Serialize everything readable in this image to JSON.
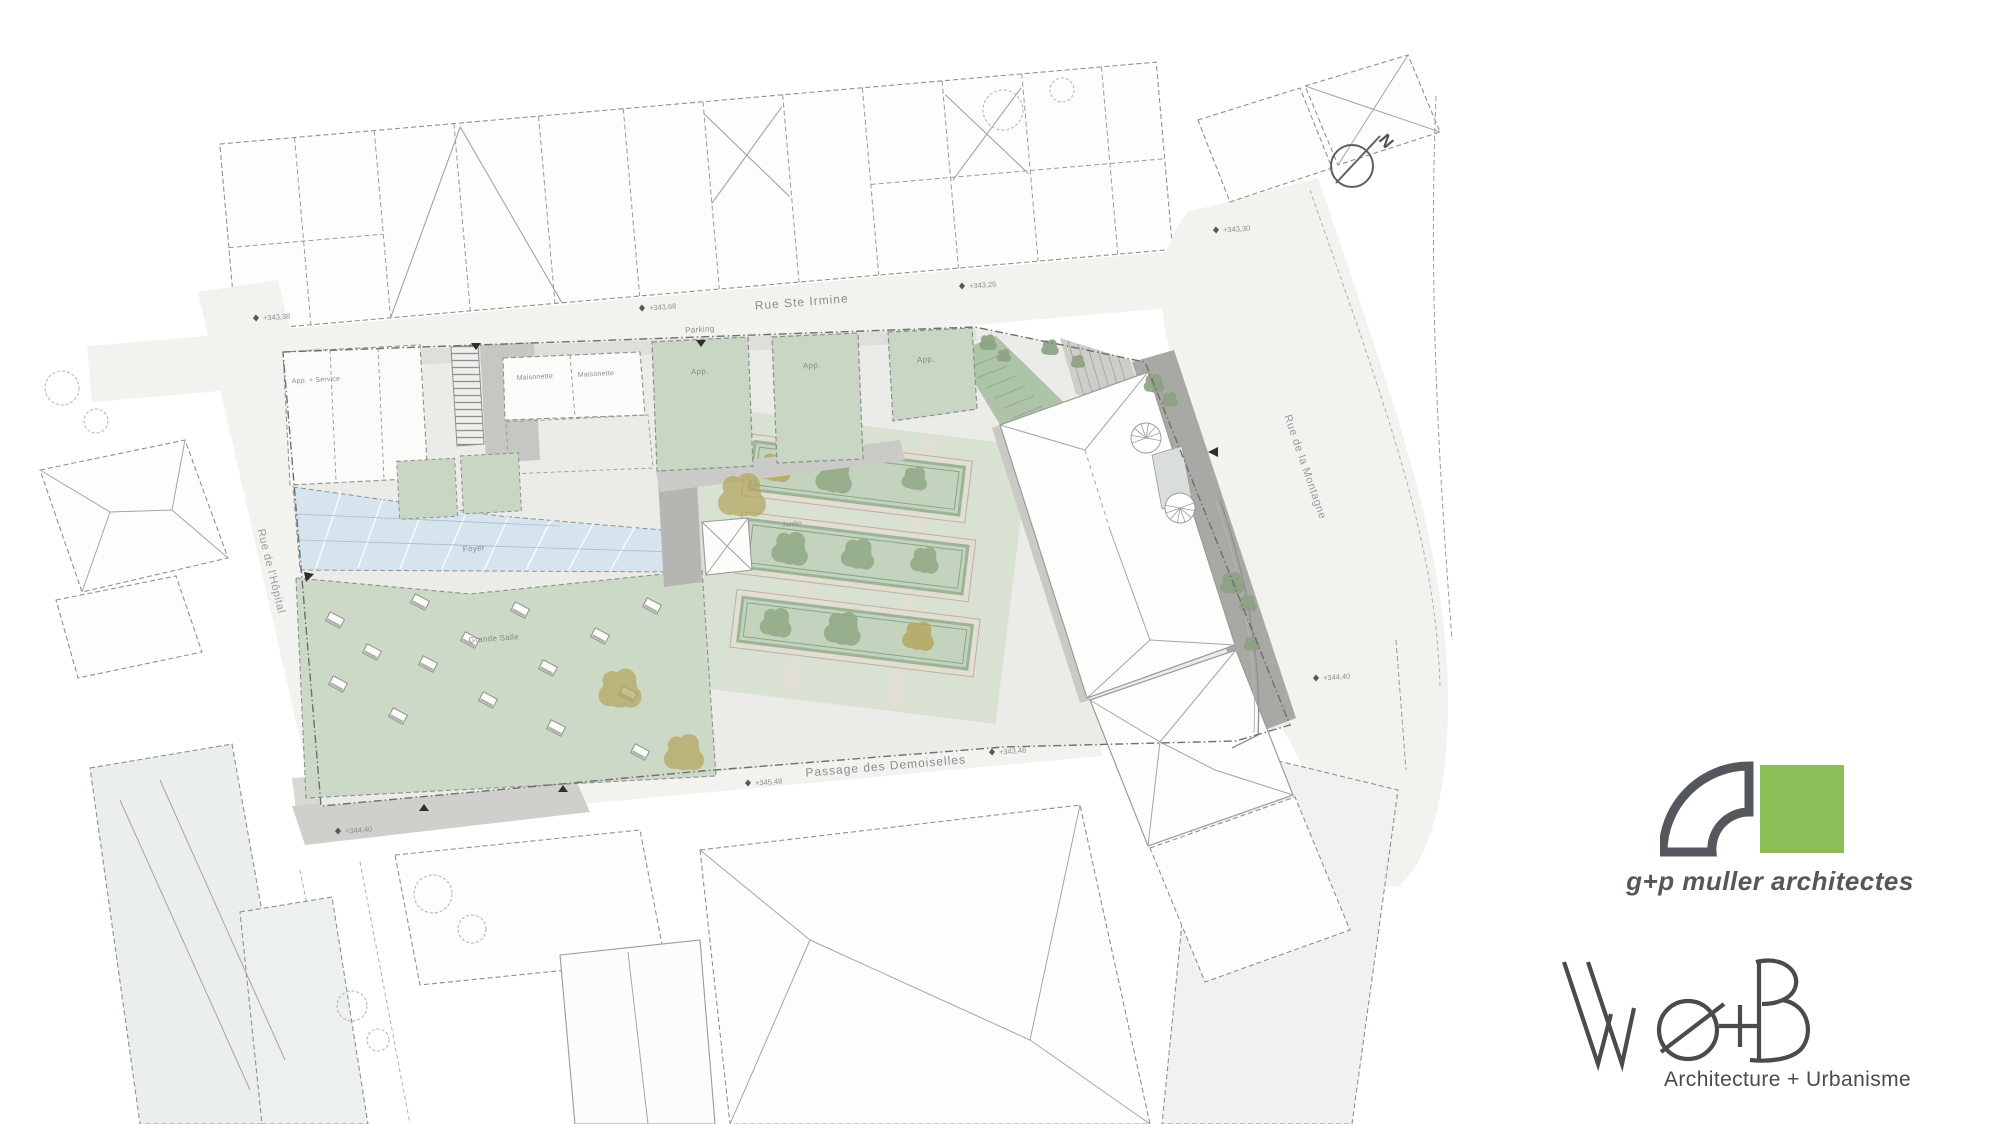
{
  "plan": {
    "streets": {
      "rue_ste_irmine": "Rue Ste Irmine",
      "rue_de_la_montagne": "Rue de la Montagne",
      "rue_de_l_hopital": "Rue de l'Hôpital",
      "passage_des_demoiselles": "Passage des Demoiselles"
    },
    "labels": {
      "parking": "Parking",
      "app_service": "App. + Service",
      "maisonette_1": "Maisonette",
      "maisonette_2": "Maisonette",
      "app_1": "App.",
      "app_2": "App.",
      "app_3": "App.",
      "foyer": "Foyer",
      "grande_salle": "Grande Salle",
      "jardin": "Jardin"
    },
    "elevations": [
      "+343,38",
      "+343,68",
      "+343,26",
      "+343,30",
      "+344,40",
      "+345,48",
      "+343,46",
      "+344,40"
    ],
    "north_label": "N"
  },
  "logos": {
    "gpmuller": {
      "name": "g+p muller architectes",
      "green": "#8bbe57",
      "gray": "#54585c"
    },
    "web": {
      "wordmark": "We+B",
      "tagline": "Architecture + Urbanisme",
      "gray": "#4b4b4b"
    }
  },
  "colors": {
    "roof_green": "#ccd9c7",
    "plot_green": "#c8d6c3",
    "glass_blue": "#d6e4ee",
    "paving_gray": "#d8d8d4",
    "dark_path": "#a8a8a4"
  }
}
